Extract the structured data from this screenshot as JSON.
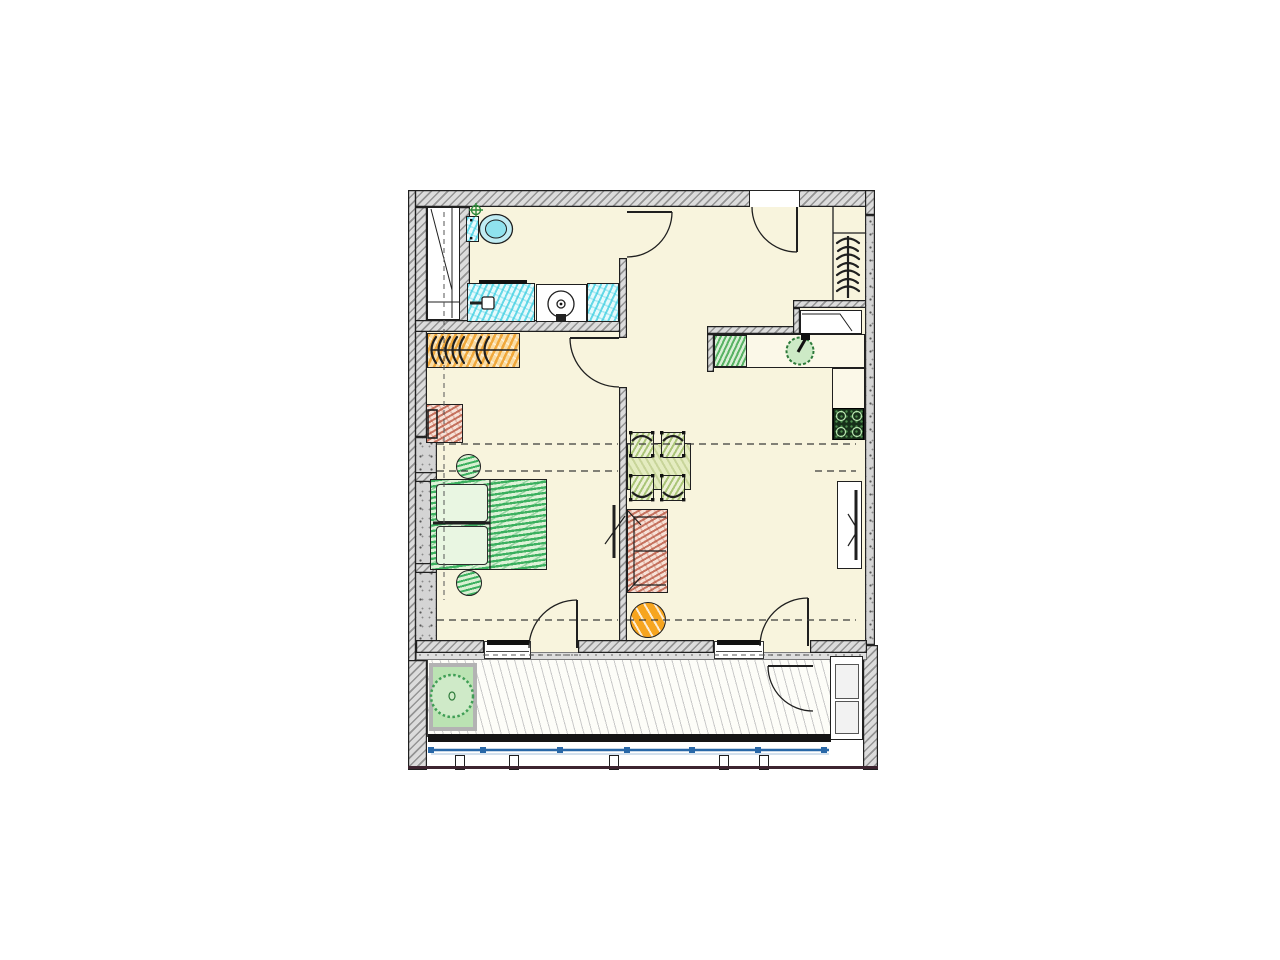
{
  "document": {
    "type": "apartment floor plan drawing",
    "text_labels": []
  },
  "colors": {
    "floor": "#f8f4dd",
    "wallHatch": "#dcdcdc",
    "wallLine": "#1f1f1f",
    "concrete": "#d4d4d4",
    "sanitaryCyan": "#49d8e8",
    "wardrobeOrange": "#f2a93b",
    "woodRed": "#bf5f4a",
    "bedGreen": "#2fae57",
    "chairGreen": "#9fbf62",
    "tableGreen": "#dce6b4",
    "kitchenGreen": "#46a850",
    "stoveDark": "#17301a",
    "poufOrange": "#f6a51f",
    "rugGreen": "#bbe3b3",
    "railBlue": "#2968a8",
    "deckLine": "#c9c9c9",
    "baseLine": "#3d2430"
  },
  "plan": {
    "rooms": [
      {
        "id": "bathroom",
        "furniture": [
          "toilet",
          "vanity-with-sink",
          "washing-machine",
          "shower-tray",
          "floor-drain",
          "duct-shaft"
        ]
      },
      {
        "id": "bedroom",
        "furniture": [
          "wardrobe-with-hangers",
          "desk-with-chair",
          "pouf",
          "double-bed-with-pillows",
          "pouf",
          "wall-mounted-tv"
        ]
      },
      {
        "id": "living-room",
        "furniture": [
          "dining-table",
          "dining-chair",
          "dining-chair",
          "dining-chair",
          "dining-chair",
          "sofa",
          "round-coffee-table",
          "tv-in-wall-niche"
        ]
      },
      {
        "id": "kitchen",
        "furniture": [
          "l-shaped-counter",
          "worktop-board",
          "round-sink-with-faucet",
          "cooktop"
        ]
      },
      {
        "id": "entry-hall",
        "furniture": [
          "coat-rack-with-hangers",
          "open-shelf",
          "shoe-shelf"
        ]
      },
      {
        "id": "balcony",
        "furniture": [
          "outdoor-rug",
          "round-bistro-table-with-chairs",
          "storage-cabinet",
          "railing-with-posts",
          "deck-floor"
        ]
      }
    ],
    "doors": [
      "entrance-door",
      "bathroom-door",
      "bedroom-door",
      "bedroom-balcony-door",
      "living-room-balcony-door",
      "balcony-swing-door"
    ],
    "windows": [
      "bedroom-window",
      "living-room-window"
    ]
  }
}
